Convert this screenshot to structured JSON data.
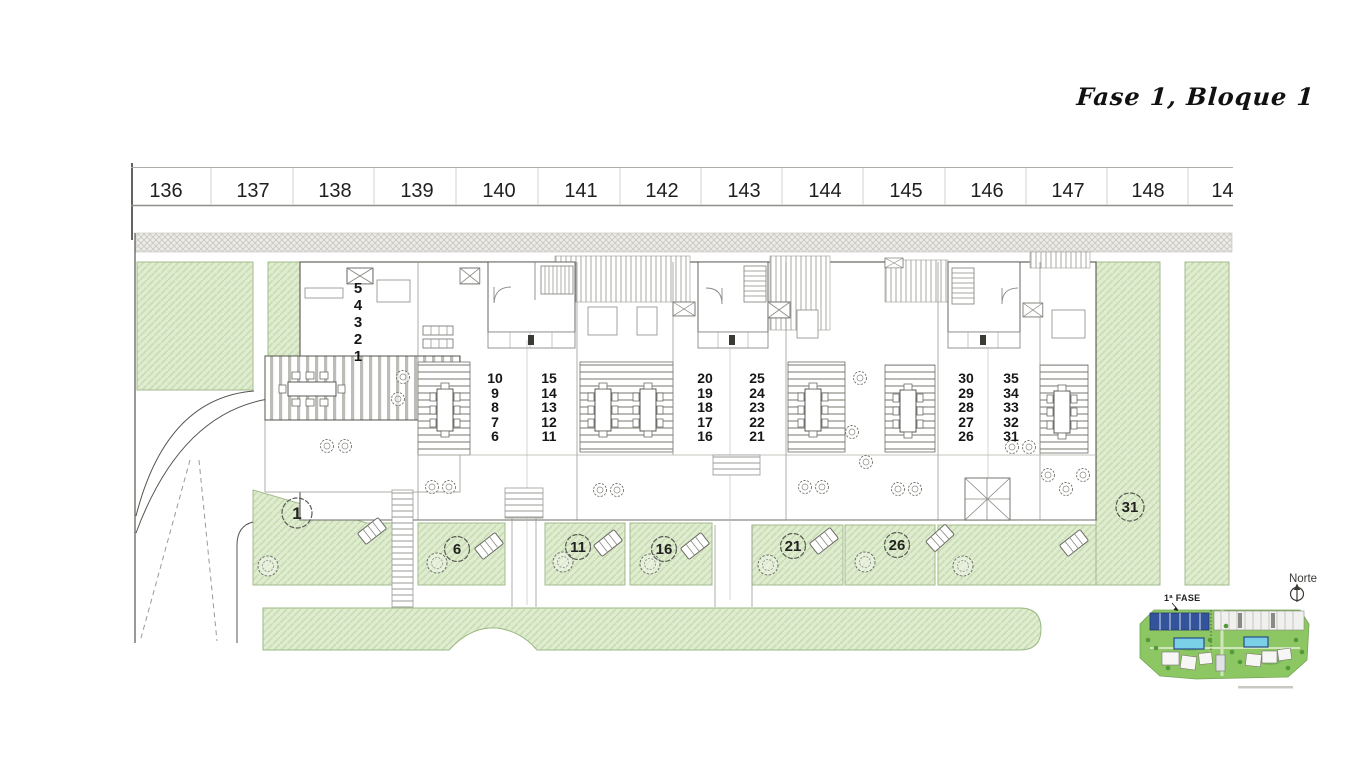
{
  "title": "Fase 1, Bloque 1",
  "ruler": {
    "labels": [
      "136",
      "137",
      "138",
      "139",
      "140",
      "141",
      "142",
      "143",
      "144",
      "145",
      "146",
      "147",
      "148",
      "149"
    ]
  },
  "stacks": [
    {
      "name": "units-5-1",
      "values": [
        "5",
        "4",
        "3",
        "2",
        "1"
      ]
    },
    {
      "name": "units-10-6",
      "values": [
        "10",
        "9",
        "8",
        "7",
        "6"
      ]
    },
    {
      "name": "units-15-11",
      "values": [
        "15",
        "14",
        "13",
        "12",
        "11"
      ]
    },
    {
      "name": "units-20-16",
      "values": [
        "20",
        "19",
        "18",
        "17",
        "16"
      ]
    },
    {
      "name": "units-25-21",
      "values": [
        "25",
        "24",
        "23",
        "22",
        "21"
      ]
    },
    {
      "name": "units-30-26",
      "values": [
        "30",
        "29",
        "28",
        "27",
        "26"
      ]
    },
    {
      "name": "units-35-31",
      "values": [
        "35",
        "34",
        "33",
        "32",
        "31"
      ]
    }
  ],
  "badges": [
    {
      "label": "1"
    },
    {
      "label": "6"
    },
    {
      "label": "11"
    },
    {
      "label": "16"
    },
    {
      "label": "21"
    },
    {
      "label": "26"
    },
    {
      "label": "31"
    }
  ],
  "compass": {
    "label": "Norte"
  },
  "minimap": {
    "phase_label": "1ª FASE"
  },
  "colors": {
    "garden_green": "#dfeccf",
    "garden_hatch": "#c8ddb2",
    "mini_green": "#8cc763",
    "phase_blue": "#33539b",
    "pool_blue": "#7ad0e6"
  }
}
